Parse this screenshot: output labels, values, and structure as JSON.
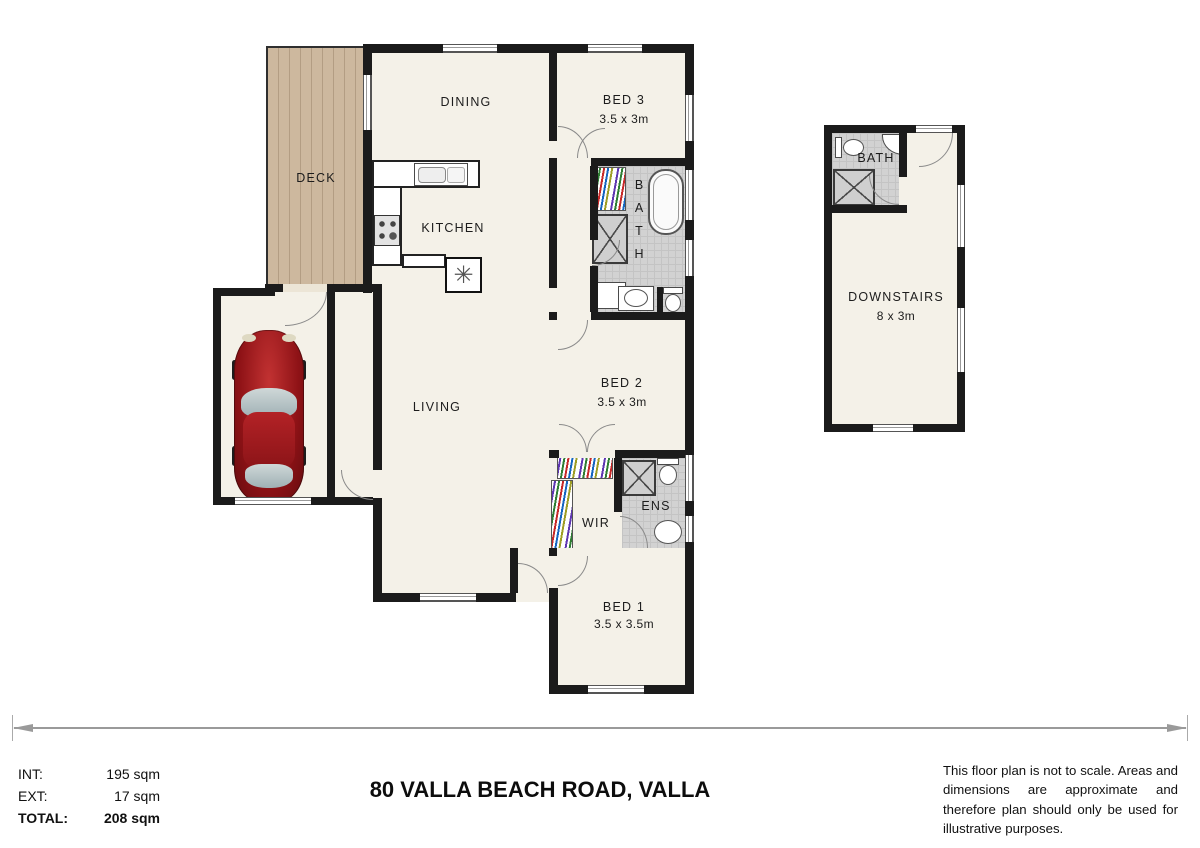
{
  "title": "80 VALLA BEACH ROAD, VALLA",
  "areas": {
    "int_label": "INT:",
    "int_value": "195 sqm",
    "ext_label": "EXT:",
    "ext_value": "17 sqm",
    "total_label": "TOTAL:",
    "total_value": "208 sqm"
  },
  "disclaimer": "This floor plan is not to scale. Areas and dimensions are approximate and therefore plan should only be used for illustrative purposes.",
  "rooms": {
    "deck": {
      "label": "DECK"
    },
    "dining": {
      "label": "DINING"
    },
    "bed3": {
      "label": "BED 3",
      "size": "3.5 x 3m"
    },
    "kitchen": {
      "label": "KITCHEN"
    },
    "bath": {
      "label": "BATH"
    },
    "living": {
      "label": "LIVING"
    },
    "bed2": {
      "label": "BED 2",
      "size": "3.5 x 3m"
    },
    "wir": {
      "label": "WIR"
    },
    "ens": {
      "label": "ENS"
    },
    "bed1": {
      "label": "BED 1",
      "size": "3.5 x 3.5m"
    },
    "bath2": {
      "label": "BATH"
    },
    "downstairs": {
      "label": "DOWNSTAIRS",
      "size": "8 x 3m"
    }
  },
  "icons": {
    "dishwasher_symbol": "✳"
  },
  "colors": {
    "wall": "#1b1b1b",
    "floor": "#f4f1e8",
    "deck_wood": "#c9b49a",
    "tile": "#d2d2d2",
    "car_body": "#8e1216",
    "dimension_line": "#9a9a9a"
  }
}
